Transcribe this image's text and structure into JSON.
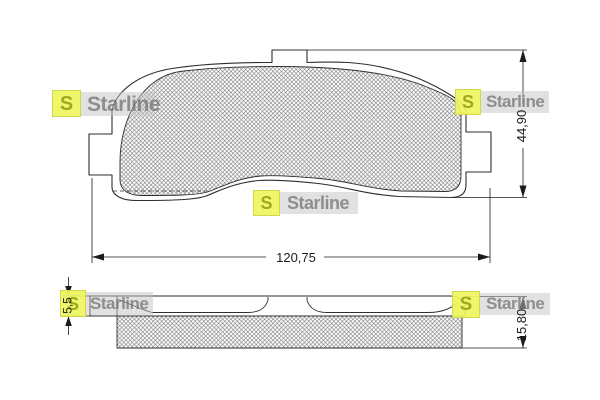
{
  "drawing": {
    "type": "brake-pad technical drawing, top view and side view with dimensions",
    "brand": "Starline",
    "logo_letter": "S",
    "dimensions": {
      "width_mm": "120,75",
      "height_mm": "44,90",
      "total_thickness_mm": "15,80",
      "plate_thickness_mm": "5,5"
    },
    "colors": {
      "outline": "#2e2e2e",
      "dimension_lines": "#1b1b1b",
      "hatch": "#6e6e6e",
      "logo_tile": "#eef55f",
      "logo_letter": "#9aa41c",
      "watermark_text": "#6e6e6e",
      "watermark_band": "#c4c4c4",
      "background": "#ffffff"
    }
  }
}
